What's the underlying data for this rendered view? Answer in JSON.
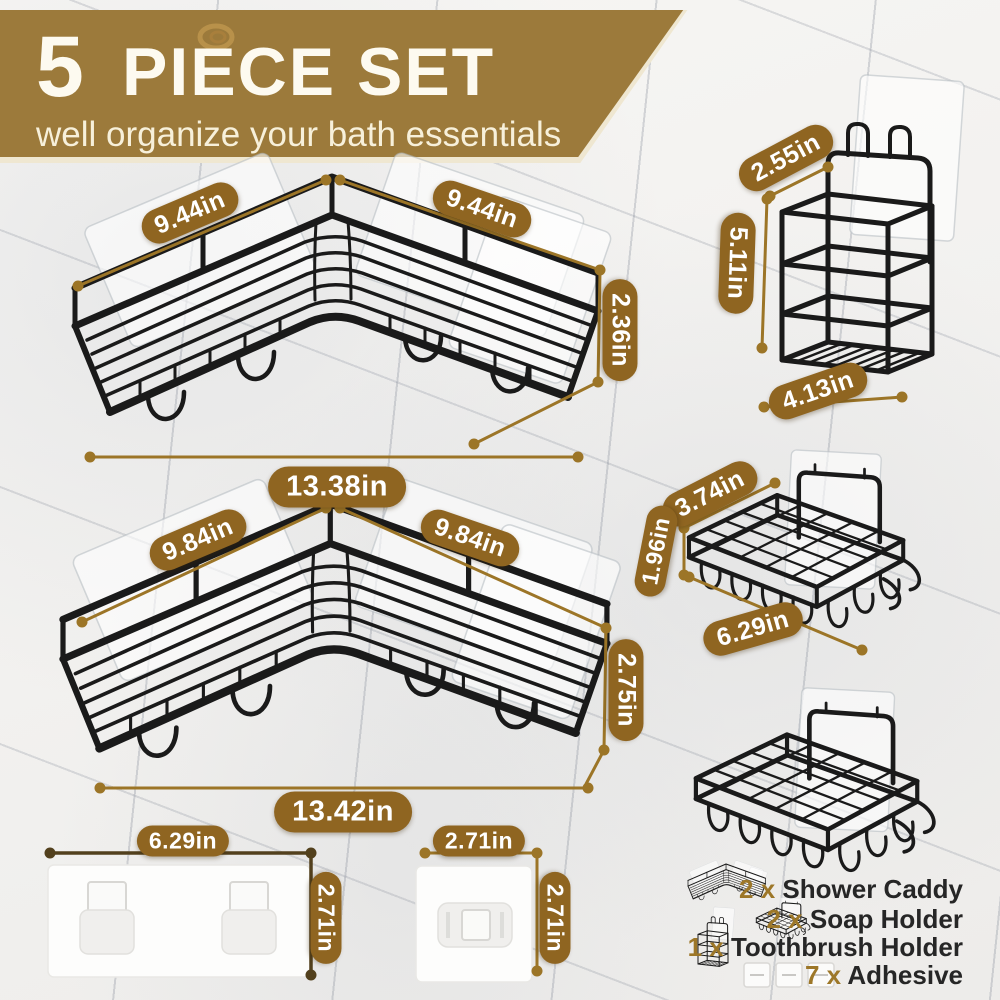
{
  "header": {
    "title_number": "5",
    "title_rest": "PIECE SET",
    "subtitle": "well organize your bath essentials",
    "decoration": "swirl-icon"
  },
  "colors": {
    "banner": "#9c7a3b",
    "banner_edge": "#efe7d1",
    "banner_text": "#fdfaf0",
    "badge": "#8f6521",
    "badge_text": "#ffffff",
    "dim_line": "#9c7527",
    "dim_line_dark": "#52401d",
    "legend_accent": "#9d7728",
    "legend_text": "#262626",
    "wire": "#1a1a1a"
  },
  "measurements": {
    "caddy1_left": "9.44in",
    "caddy1_right": "9.44in",
    "caddy1_height": "2.36in",
    "caddy1_width": "13.38in",
    "caddy2_left": "9.84in",
    "caddy2_right": "9.84in",
    "caddy2_height": "2.75in",
    "caddy2_width": "13.42in",
    "toothbrush_depth": "2.55in",
    "toothbrush_height": "5.11in",
    "toothbrush_width": "4.13in",
    "soap_depth": "3.74in",
    "soap_height": "1.96in",
    "soap_width": "6.29in",
    "adhesive_wide_width": "6.29in",
    "adhesive_wide_height": "2.71in",
    "adhesive_square_width": "2.71in",
    "adhesive_square_height": "2.71in"
  },
  "legend": {
    "items": [
      {
        "qty": "2 x",
        "label": "Shower Caddy",
        "icon": "corner-caddy-icon"
      },
      {
        "qty": "2 x",
        "label": "Soap Holder",
        "icon": "soap-holder-icon"
      },
      {
        "qty": "1 x",
        "label": "Toothbrush Holder",
        "icon": "toothbrush-holder-icon"
      },
      {
        "qty": "7 x",
        "label": "Adhesive",
        "icon": "adhesive-icon"
      }
    ]
  }
}
